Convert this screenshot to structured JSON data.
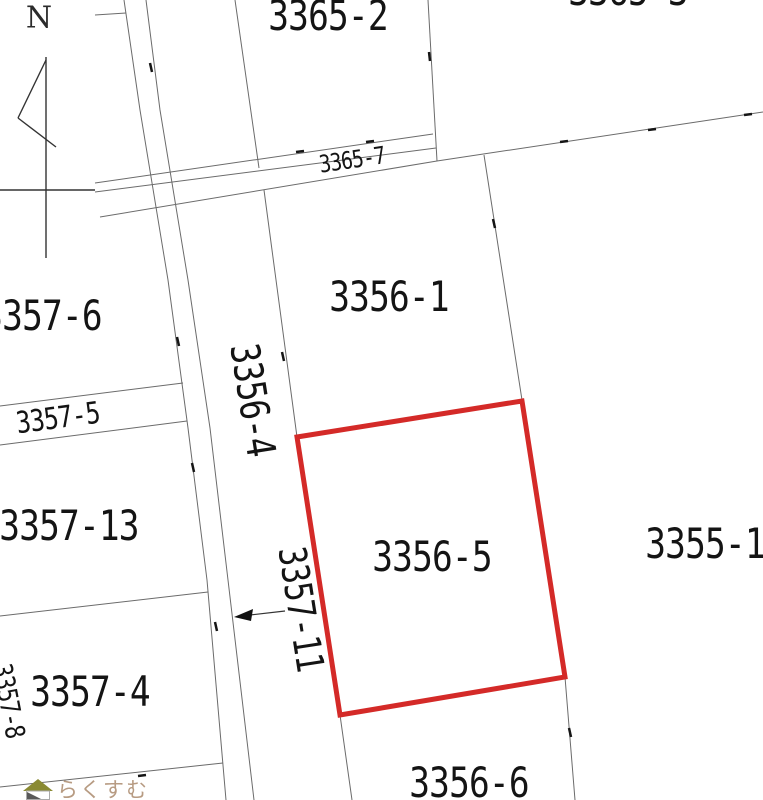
{
  "map": {
    "compass": {
      "label": "N"
    },
    "highlight": {
      "parcel": "3356-5",
      "color": "#d42a28"
    },
    "watermark": {
      "text": "らくすむ",
      "text_color": "#b79b82",
      "roof_color": "#8a8a33",
      "accent_color": "#595959"
    },
    "parcels": [
      {
        "label": "3365-2"
      },
      {
        "label": "3365-3"
      },
      {
        "label": "3365-7"
      },
      {
        "label": "3356-1"
      },
      {
        "label": "3356-4"
      },
      {
        "label": "3356-5"
      },
      {
        "label": "3356-6"
      },
      {
        "label": "3355-1"
      },
      {
        "label": "3357-6"
      },
      {
        "label": "3357-5"
      },
      {
        "label": "3357-13"
      },
      {
        "label": "3357-4"
      },
      {
        "label": "3357-8"
      },
      {
        "label": "3357-11"
      }
    ]
  }
}
